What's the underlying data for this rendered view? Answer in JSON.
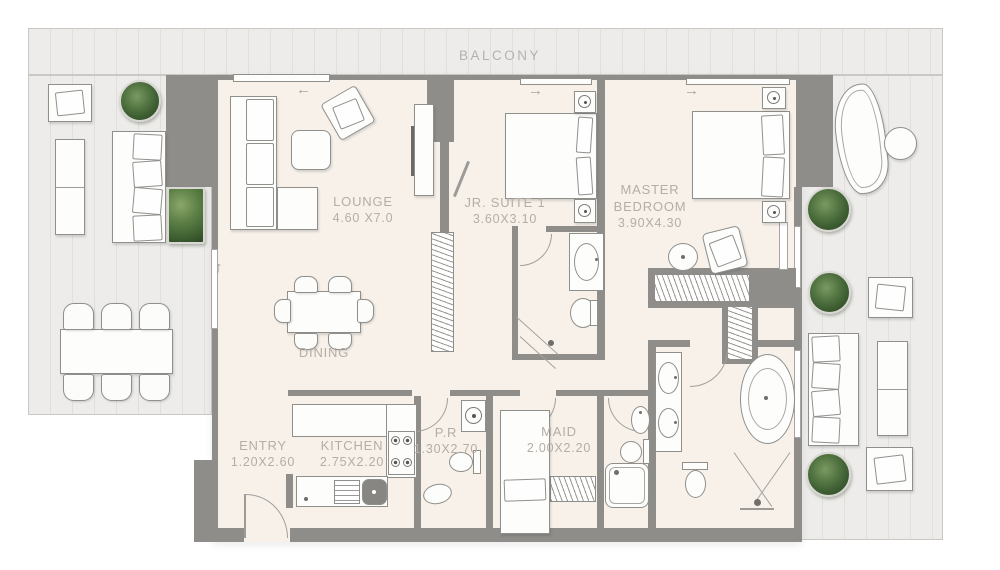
{
  "floorplan": {
    "balcony": {
      "label": "BALCONY"
    },
    "rooms": {
      "lounge": {
        "label": "LOUNGE",
        "dims": "4.60 X7.0"
      },
      "jr_suite": {
        "label": "JR. SUITE 1",
        "dims": "3.60X3.10"
      },
      "master_bedroom": {
        "label": "MASTER BEDROOM",
        "dims": "3.90X4.30"
      },
      "dining": {
        "label": "DINING"
      },
      "entry": {
        "label": "ENTRY",
        "dims": "1.20X2.60"
      },
      "kitchen": {
        "label": "KITCHEN",
        "dims": "2.75X2.20"
      },
      "powder_room": {
        "label": "P.R",
        "dims": "1.30X2.70"
      },
      "maid": {
        "label": "MAID",
        "dims": "2.00X2.20"
      }
    },
    "glyphs": {
      "slide_left": "←",
      "slide_right": "→",
      "slide_up": "↑"
    },
    "colors": {
      "deck": "#edecea",
      "floor": "#f7f1ea",
      "wall": "#8e8d8a",
      "label_text": "#b6ada4",
      "plant_green": "#4c6b3c",
      "background": "#ffffff"
    }
  }
}
